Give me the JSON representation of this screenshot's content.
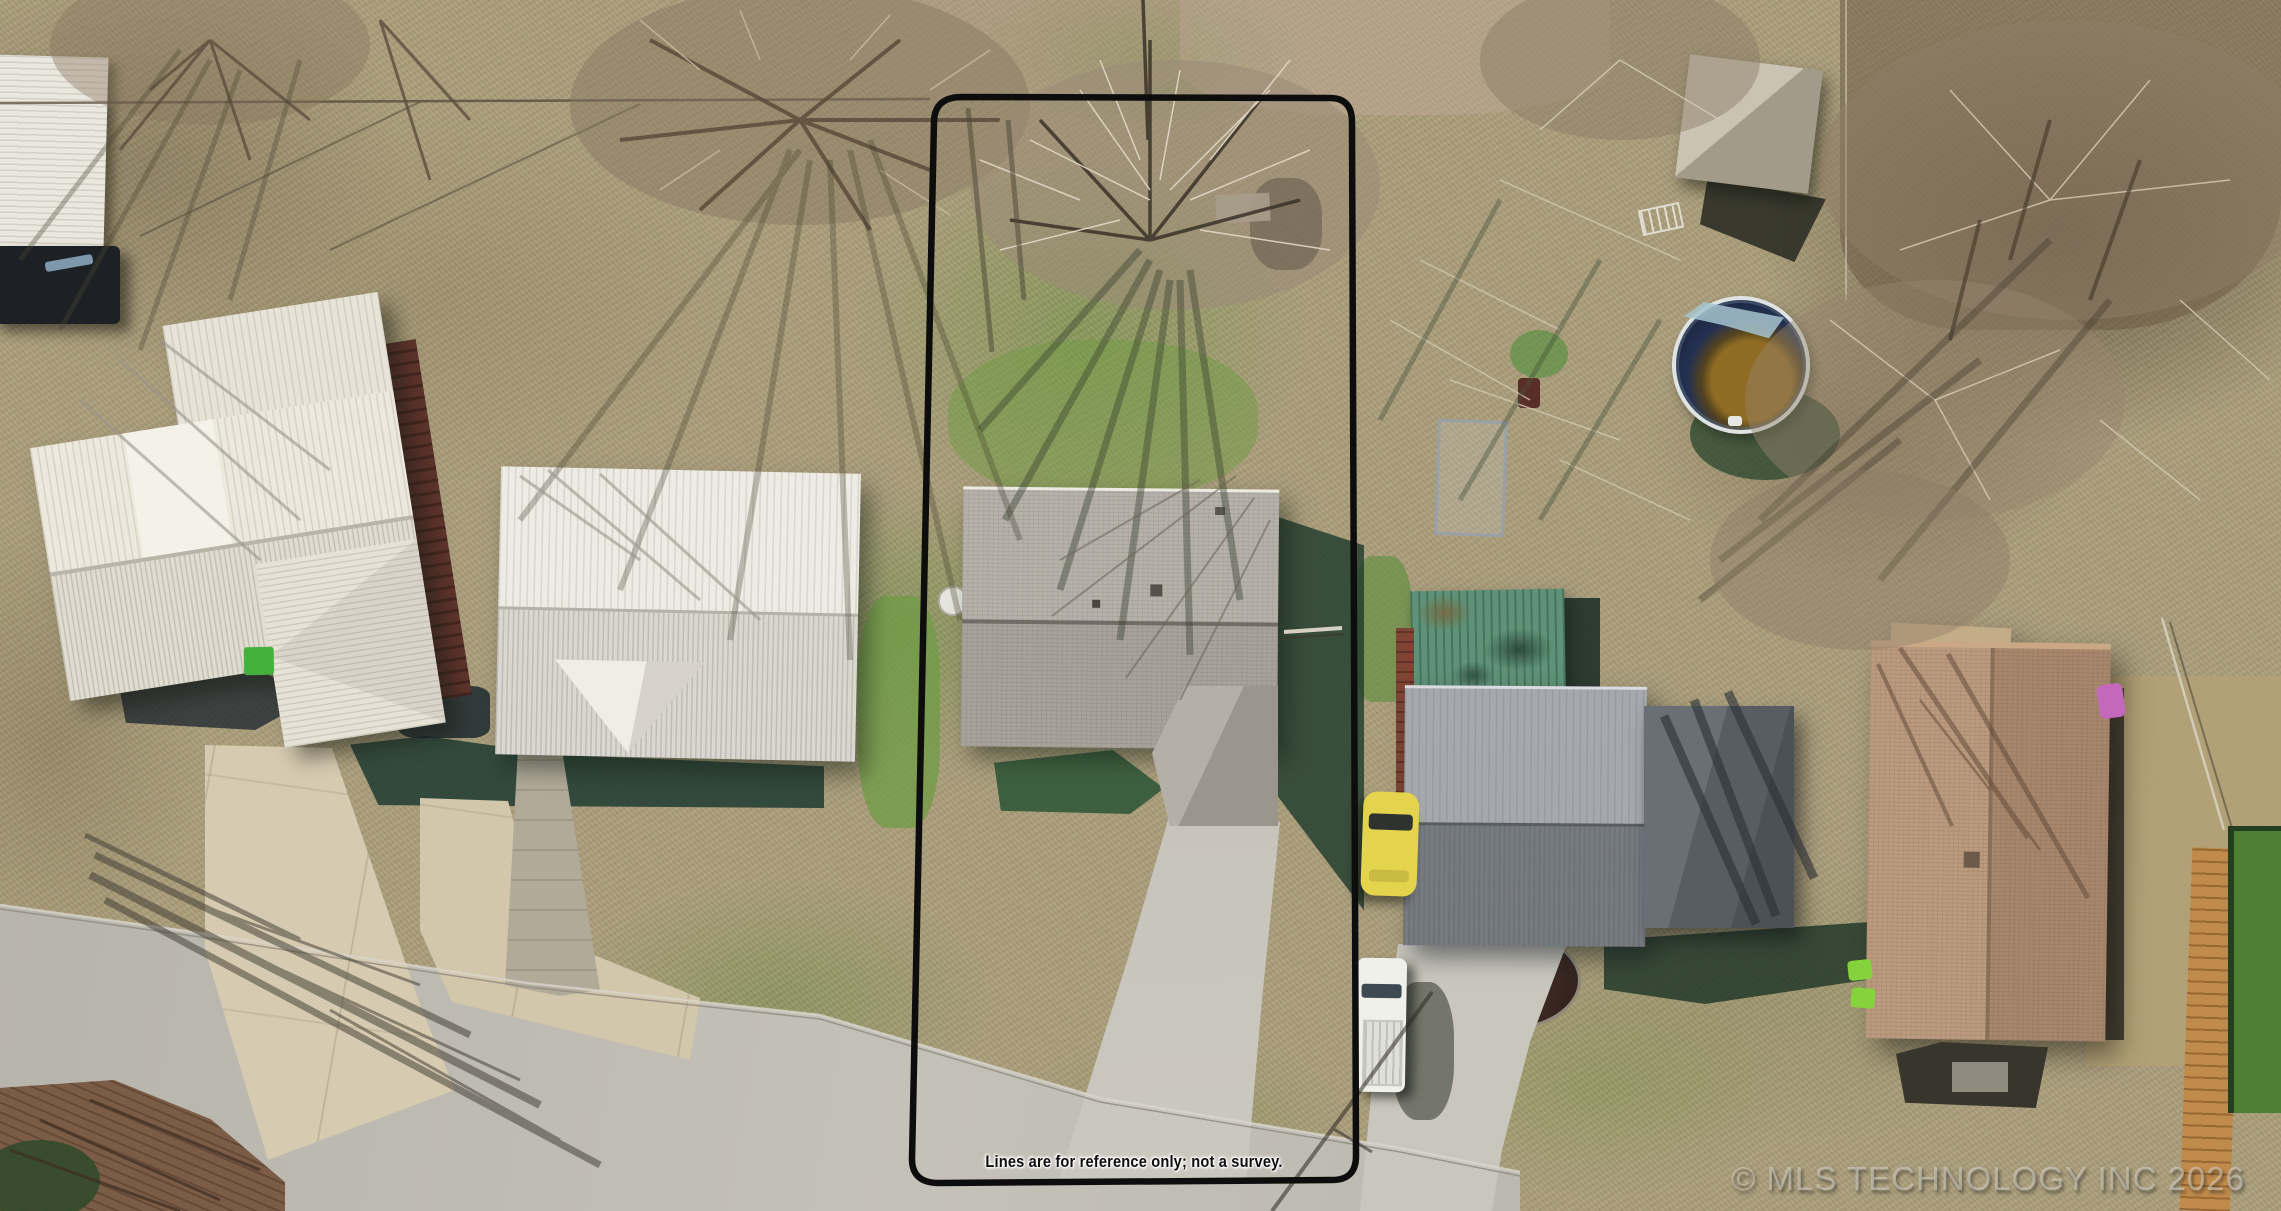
{
  "scene": {
    "kind": "aerial-drone-photo",
    "subject": "residential-lot-with-parcel-outline",
    "palette": {
      "grass_tan": "#ab9e7b",
      "grass_green": "#6f9c44",
      "shadow_green": "#1d3a30",
      "street_concrete": "#b7b4ab",
      "driveway_concrete": "#d3c7ab",
      "roof_white_metal": "#e9e5d8",
      "roof_gray_shingle": "#aeaaa2",
      "roof_dark_metal": "#787d84",
      "roof_green_metal": "#5f9278",
      "roof_brown_shingle": "#b2906f",
      "pool_water": "#1d2944",
      "pool_debris": "#926f24",
      "boundary_line": "#0d0d0d",
      "car_yellow": "#e3d14b",
      "van_white": "#f0efe8"
    }
  },
  "overlays": {
    "disclaimer": "Lines are for reference only; not a survey.",
    "watermark": "© MLS TECHNOLOGY INC 2026"
  }
}
